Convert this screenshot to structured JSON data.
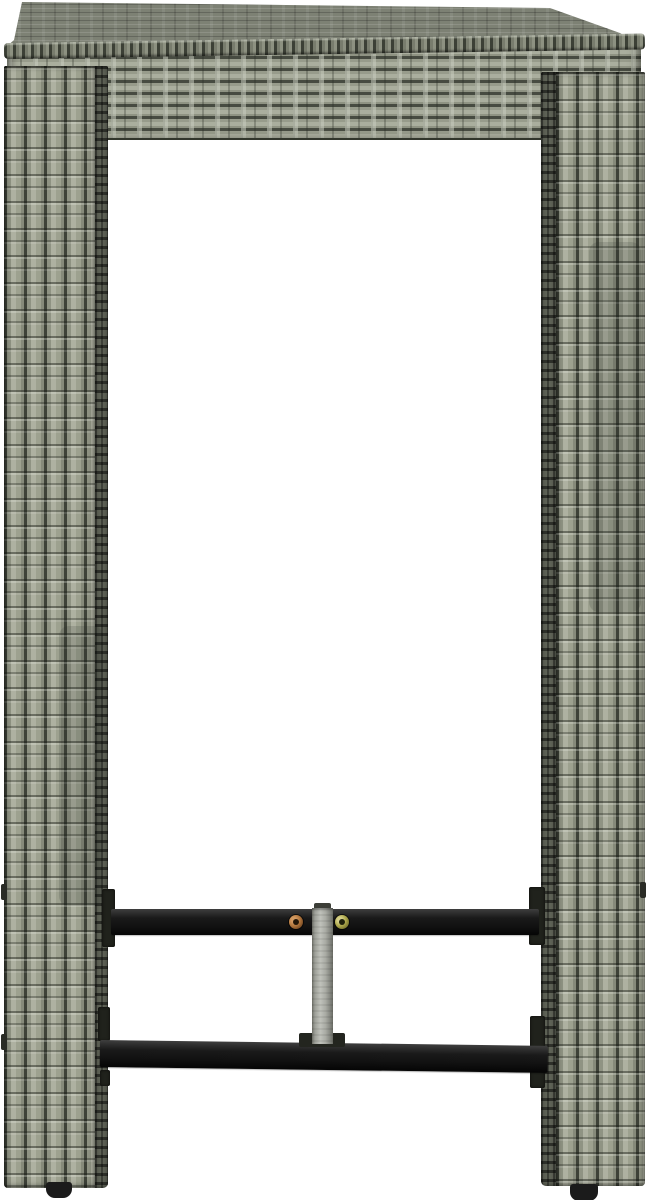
{
  "page": {
    "background_color": "#ffffff"
  },
  "scene": {
    "type": "product-photo",
    "subject": "poly rattan bar table",
    "description": "Tall grey poly rattan outdoor bar table with a square woven tabletop, two wide woven panel legs, a black steel footrest frame with two crossbars, a grey centre strut and two fastening screws, photographed on a plain white background.",
    "parts": {
      "tabletop": "Square woven poly rattan tabletop with braided front edge and apron",
      "tabletop_surface": "Woven top surface of the tabletop seen at a shallow angle",
      "tabletop_edge": "Braided front edge of the tabletop",
      "tabletop_apron": "Horizontally woven apron band under the tabletop",
      "left_leg": "Left woven poly rattan panel leg",
      "right_leg": "Right woven poly rattan panel leg",
      "upper_crossbar": "Upper black steel footrest crossbar",
      "lower_crossbar": "Lower black steel footrest crossbar",
      "center_strut": "Grey steel centre strut joining the two crossbars",
      "copper_screw": "Copper coloured fixing screw on the upper crossbar",
      "zinc_screw": "Zinc coloured fixing screw on the upper crossbar",
      "left_foot": "Black foot cap under the left leg",
      "right_foot": "Black foot cap under the right leg",
      "mounting_brackets": "Black mounting brackets fixing the crossbars to the legs"
    }
  },
  "palette": {
    "bg": "#ffffff",
    "rattan-light": "#aaae9e",
    "rattan-mid": "#8f9383",
    "rattan-dark": "#474b41",
    "rattan-deep": "#32362c",
    "rattan-side": "#5f6357",
    "top-surface": "#7d8174",
    "metal-dark": "#121212",
    "metal-mid": "#2e2e2e",
    "strut-light": "#c0c2bb",
    "strut-dark": "#75776f",
    "screw-copper": "#b5793f",
    "screw-zinc": "#b0aa4e",
    "foot": "#1b1b1b"
  }
}
